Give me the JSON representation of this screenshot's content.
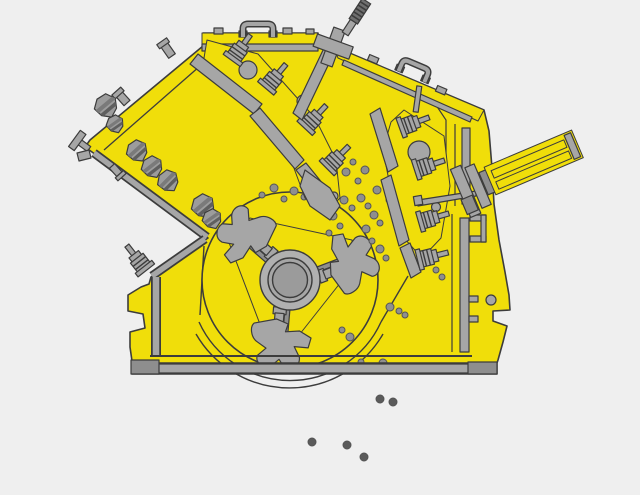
{
  "diagram": {
    "subject": "impact-crusher-cutaway",
    "background": "#efefef",
    "colors": {
      "housing_yellow": "#f0de0a",
      "metal_gray": "#a6a6a6",
      "metal_dark": "#8e8e8e",
      "knurl_gray": "#6f6f6f",
      "outline": "#3c3c3c",
      "rock_fill": "#9c9c9c",
      "rock_stripe1": "#7a7a7a",
      "rock_stripe2": "#5f5f5f",
      "particle_fill": "#8f8f8f",
      "particle_edge": "#555555",
      "debris_fill": "#5a5a5a"
    },
    "rotor": {
      "cx": 290,
      "cy": 280,
      "radius": 88,
      "hub_radii": [
        30,
        22,
        17.5
      ],
      "blow_bar_count": 3,
      "blow_bar_rotations": [
        131,
        -111,
        5
      ]
    },
    "feed_rocks": [
      {
        "x": 106,
        "y": 106,
        "r": 12,
        "rot": -40
      },
      {
        "x": 115,
        "y": 124,
        "r": 9,
        "rot": -35
      },
      {
        "x": 137,
        "y": 151,
        "r": 11,
        "rot": -42
      },
      {
        "x": 152,
        "y": 167,
        "r": 11,
        "rot": -38
      },
      {
        "x": 168,
        "y": 181,
        "r": 11,
        "rot": -45
      },
      {
        "x": 203,
        "y": 206,
        "r": 12,
        "rot": -40
      },
      {
        "x": 212,
        "y": 219,
        "r": 10,
        "rot": -35
      }
    ],
    "spring_bolts": [
      {
        "x": 232,
        "y": 60,
        "rot": 36
      },
      {
        "x": 266,
        "y": 88,
        "rot": 40
      },
      {
        "x": 305,
        "y": 128,
        "rot": 43
      },
      {
        "x": 327,
        "y": 168,
        "rot": 45
      },
      {
        "x": 400,
        "y": 128,
        "rot": 70
      },
      {
        "x": 415,
        "y": 170,
        "rot": 72
      },
      {
        "x": 419,
        "y": 222,
        "rot": 74
      },
      {
        "x": 418,
        "y": 260,
        "rot": 76
      },
      {
        "x": 146,
        "y": 270,
        "rot": -38
      }
    ],
    "crushed_particles": [
      [
        262,
        195,
        3
      ],
      [
        274,
        188,
        4
      ],
      [
        284,
        199,
        3
      ],
      [
        294,
        191,
        4
      ],
      [
        304,
        197,
        3
      ],
      [
        314,
        188,
        4
      ],
      [
        322,
        197,
        3
      ],
      [
        334,
        192,
        4
      ],
      [
        344,
        200,
        4
      ],
      [
        352,
        208,
        3
      ],
      [
        361,
        198,
        4
      ],
      [
        368,
        206,
        3
      ],
      [
        374,
        215,
        4
      ],
      [
        380,
        223,
        3
      ],
      [
        366,
        229,
        4
      ],
      [
        372,
        241,
        3
      ],
      [
        380,
        249,
        4
      ],
      [
        386,
        258,
        3
      ],
      [
        377,
        190,
        4
      ],
      [
        389,
        200,
        3
      ],
      [
        396,
        211,
        4
      ],
      [
        358,
        181,
        3
      ],
      [
        346,
        172,
        4
      ],
      [
        353,
        162,
        3
      ],
      [
        365,
        170,
        4
      ],
      [
        325,
        206,
        3
      ],
      [
        333,
        216,
        4
      ],
      [
        340,
        226,
        3
      ],
      [
        329,
        233,
        3
      ],
      [
        390,
        307,
        4
      ],
      [
        399,
        311,
        3
      ],
      [
        405,
        315,
        3
      ],
      [
        424,
        222,
        3
      ],
      [
        429,
        231,
        3
      ],
      [
        436,
        270,
        3
      ],
      [
        442,
        277,
        3
      ],
      [
        383,
        363,
        4
      ],
      [
        350,
        337,
        4
      ],
      [
        361,
        362,
        3
      ],
      [
        342,
        330,
        3
      ]
    ],
    "falling_debris": [
      [
        380,
        399,
        4
      ],
      [
        393,
        402,
        4
      ],
      [
        312,
        442,
        4
      ],
      [
        347,
        445,
        4
      ],
      [
        364,
        457,
        4
      ]
    ],
    "components": [
      "housing",
      "feed-chute",
      "feed-opening-notch",
      "top-lid",
      "lid-handle",
      "roof-panel",
      "roof-handle",
      "suspension-cross-bracket",
      "threaded-suspension-rod",
      "impact-apron-1",
      "impact-apron-2",
      "spring-bolt-assemblies",
      "rotor",
      "blow-bars",
      "rotor-hub",
      "hydraulic-adjustment-cylinder",
      "cylinder-link-rod",
      "base-frame",
      "left-foot",
      "right-foot",
      "rear-wall-channel",
      "feed-rocks",
      "crushed-particles",
      "falling-debris"
    ]
  }
}
